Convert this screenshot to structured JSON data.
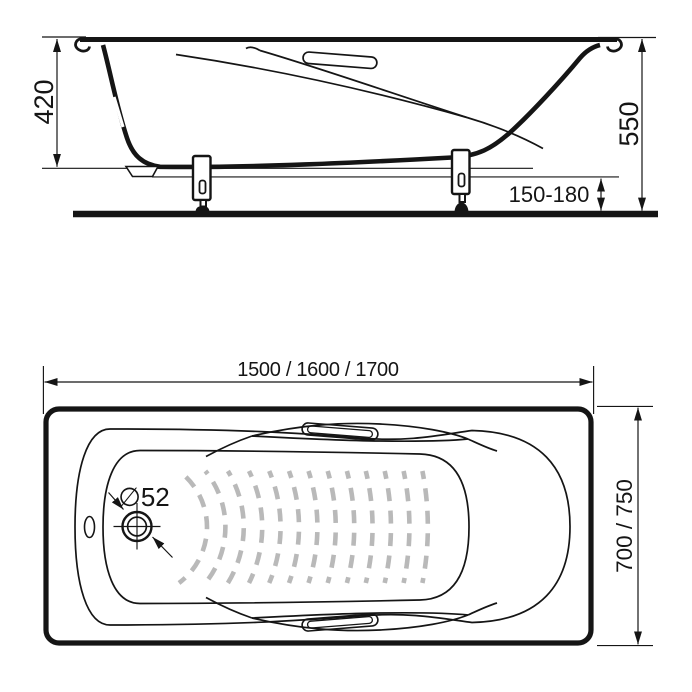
{
  "drawing": {
    "colors": {
      "line": "#151515",
      "pattern": "#b9b9b9",
      "background": "#ffffff"
    },
    "side_view": {
      "depth_label": "420",
      "total_height_label": "550",
      "leg_height_label": "150-180"
    },
    "top_view": {
      "length_label": "1500 / 1600 / 1700",
      "width_label": "700 / 750",
      "drain_diameter_label": "∅52"
    }
  }
}
